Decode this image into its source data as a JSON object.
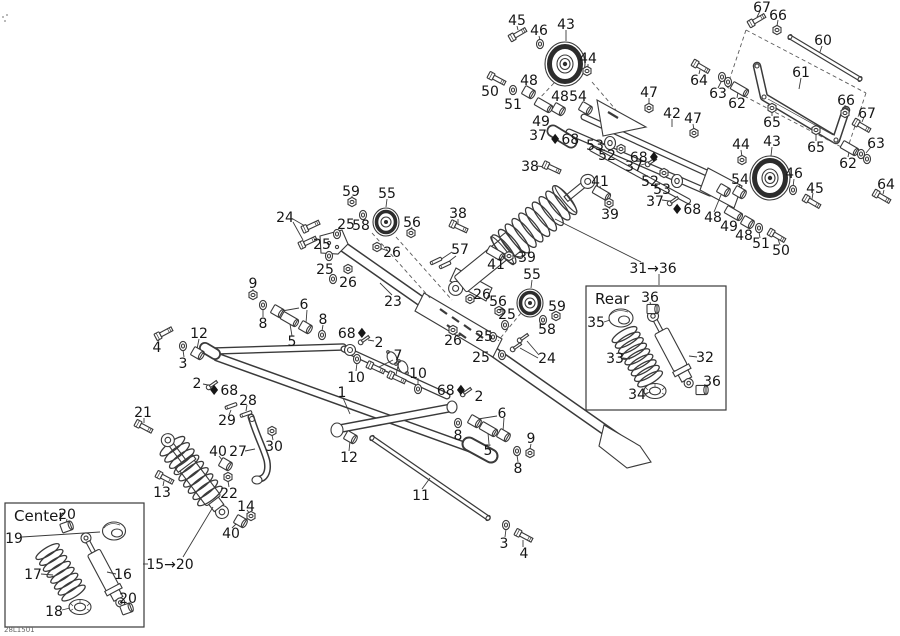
{
  "meta": {
    "drawing_number": "28L1501",
    "background": "#ffffff",
    "line_color": "#3a3a3a",
    "label_color": "#161616",
    "label_font_size": 14
  },
  "insets": [
    {
      "id": "center-inset",
      "label": "Center",
      "x": 5,
      "y": 503,
      "w": 139,
      "h": 124
    },
    {
      "id": "rear-inset",
      "label": "Rear",
      "x": 586,
      "y": 286,
      "w": 140,
      "h": 124
    }
  ],
  "callouts": [
    [
      "45",
      517,
      20
    ],
    [
      "46",
      539,
      30
    ],
    [
      "43",
      566,
      24
    ],
    [
      "44",
      588,
      58
    ],
    [
      "48",
      529,
      80
    ],
    [
      "50",
      490,
      91
    ],
    [
      "51",
      513,
      104
    ],
    [
      "49",
      541,
      121
    ],
    [
      "48",
      560,
      96
    ],
    [
      "54",
      578,
      96
    ],
    [
      "37",
      538,
      135
    ],
    [
      "♦68",
      564,
      139
    ],
    [
      "53",
      595,
      145
    ],
    [
      "52",
      607,
      155
    ],
    [
      "38",
      530,
      166
    ],
    [
      "38",
      458,
      213
    ],
    [
      "41",
      600,
      181
    ],
    [
      "39",
      610,
      214
    ],
    [
      "57",
      460,
      249
    ],
    [
      "41",
      496,
      264
    ],
    [
      "39",
      527,
      257
    ],
    [
      "55",
      532,
      274
    ],
    [
      "26",
      482,
      294
    ],
    [
      "56",
      498,
      301
    ],
    [
      "25",
      507,
      314
    ],
    [
      "59",
      557,
      306
    ],
    [
      "58",
      547,
      329
    ],
    [
      "26",
      453,
      340
    ],
    [
      "25",
      484,
      336
    ],
    [
      "25",
      481,
      357
    ],
    [
      "24",
      547,
      358
    ],
    [
      "59",
      351,
      191
    ],
    [
      "55",
      387,
      193
    ],
    [
      "24",
      285,
      217
    ],
    [
      "25",
      346,
      224
    ],
    [
      "58",
      361,
      225
    ],
    [
      "56",
      412,
      222
    ],
    [
      "25",
      322,
      244
    ],
    [
      "25",
      325,
      269
    ],
    [
      "26",
      348,
      282
    ],
    [
      "26",
      392,
      252
    ],
    [
      "23",
      393,
      301
    ],
    [
      "31→36",
      653,
      268
    ],
    [
      "9",
      253,
      283
    ],
    [
      "6",
      304,
      304
    ],
    [
      "8",
      263,
      323
    ],
    [
      "5",
      292,
      341
    ],
    [
      "8",
      323,
      319
    ],
    [
      "68♦",
      353,
      333
    ],
    [
      "2",
      379,
      342
    ],
    [
      "4",
      157,
      347
    ],
    [
      "12",
      199,
      333
    ],
    [
      "3",
      183,
      363
    ],
    [
      "2",
      197,
      383
    ],
    [
      "♦68",
      223,
      390
    ],
    [
      "10",
      356,
      377
    ],
    [
      "7",
      398,
      355
    ],
    [
      "10",
      418,
      373
    ],
    [
      "1",
      342,
      392
    ],
    [
      "68♦",
      452,
      390
    ],
    [
      "2",
      479,
      396
    ],
    [
      "8",
      458,
      435
    ],
    [
      "6",
      502,
      413
    ],
    [
      "5",
      488,
      450
    ],
    [
      "8",
      518,
      468
    ],
    [
      "9",
      531,
      438
    ],
    [
      "12",
      349,
      457
    ],
    [
      "11",
      421,
      495
    ],
    [
      "3",
      504,
      543
    ],
    [
      "4",
      524,
      553
    ],
    [
      "28",
      248,
      400
    ],
    [
      "29",
      227,
      420
    ],
    [
      "30",
      274,
      446
    ],
    [
      "27",
      238,
      451
    ],
    [
      "40",
      218,
      451
    ],
    [
      "21",
      143,
      412
    ],
    [
      "13",
      162,
      492
    ],
    [
      "22",
      229,
      493
    ],
    [
      "14",
      246,
      506
    ],
    [
      "40",
      231,
      533
    ],
    [
      "15→20",
      170,
      564
    ],
    [
      "42",
      672,
      113
    ],
    [
      "47",
      649,
      92
    ],
    [
      "47",
      693,
      118
    ],
    [
      "68♦",
      645,
      157
    ],
    [
      "37",
      634,
      166
    ],
    [
      "52",
      650,
      181
    ],
    [
      "53",
      662,
      189
    ],
    [
      "37",
      655,
      201
    ],
    [
      "♦68",
      686,
      209
    ],
    [
      "67",
      762,
      7
    ],
    [
      "66",
      778,
      15
    ],
    [
      "60",
      823,
      40
    ],
    [
      "61",
      801,
      72
    ],
    [
      "64",
      699,
      80
    ],
    [
      "63",
      718,
      93
    ],
    [
      "62",
      737,
      103
    ],
    [
      "65",
      772,
      122
    ],
    [
      "66",
      846,
      100
    ],
    [
      "67",
      867,
      113
    ],
    [
      "65",
      816,
      147
    ],
    [
      "63",
      876,
      143
    ],
    [
      "62",
      848,
      163
    ],
    [
      "64",
      886,
      184
    ],
    [
      "44",
      741,
      144
    ],
    [
      "43",
      772,
      141
    ],
    [
      "46",
      794,
      173
    ],
    [
      "45",
      815,
      188
    ],
    [
      "54",
      740,
      179
    ],
    [
      "48",
      713,
      217
    ],
    [
      "49",
      729,
      226
    ],
    [
      "48",
      744,
      235
    ],
    [
      "51",
      761,
      243
    ],
    [
      "50",
      781,
      250
    ],
    [
      "36",
      650,
      297
    ],
    [
      "35",
      596,
      322
    ],
    [
      "33",
      615,
      358
    ],
    [
      "32",
      705,
      357
    ],
    [
      "36",
      712,
      381
    ],
    [
      "34",
      637,
      394
    ],
    [
      "20",
      67,
      514
    ],
    [
      "19",
      14,
      538
    ],
    [
      "17",
      33,
      574
    ],
    [
      "16",
      123,
      574
    ],
    [
      "18",
      54,
      611
    ],
    [
      "20",
      128,
      598
    ]
  ],
  "leaders": [
    [
      293,
      219,
      305,
      226
    ],
    [
      293,
      222,
      303,
      240
    ],
    [
      299,
      308,
      282,
      311
    ],
    [
      307,
      310,
      306,
      323
    ],
    [
      292,
      336,
      290,
      324
    ],
    [
      263,
      317,
      263,
      309
    ],
    [
      253,
      289,
      253,
      292
    ],
    [
      323,
      325,
      322,
      331
    ],
    [
      184,
      357,
      183,
      350
    ],
    [
      199,
      339,
      197,
      349
    ],
    [
      158,
      341,
      162,
      337
    ],
    [
      203,
      384,
      208,
      385
    ],
    [
      374,
      341,
      368,
      340
    ],
    [
      393,
      360,
      379,
      367
    ],
    [
      399,
      361,
      396,
      375
    ],
    [
      356,
      371,
      357,
      363
    ],
    [
      418,
      378,
      418,
      385
    ],
    [
      343,
      398,
      350,
      414
    ],
    [
      422,
      489,
      430,
      478
    ],
    [
      349,
      451,
      350,
      441
    ],
    [
      505,
      537,
      506,
      529
    ],
    [
      523,
      547,
      523,
      540
    ],
    [
      531,
      444,
      530,
      449
    ],
    [
      518,
      462,
      517,
      455
    ],
    [
      497,
      416,
      478,
      419
    ],
    [
      504,
      418,
      503,
      431
    ],
    [
      489,
      444,
      488,
      433
    ],
    [
      392,
      295,
      380,
      283
    ],
    [
      387,
      199,
      386,
      207
    ],
    [
      532,
      280,
      531,
      288
    ],
    [
      412,
      227,
      411,
      230
    ],
    [
      388,
      251,
      380,
      248
    ],
    [
      539,
      355,
      527,
      341
    ],
    [
      538,
      358,
      520,
      348
    ],
    [
      452,
      252,
      440,
      260
    ],
    [
      456,
      256,
      447,
      263
    ],
    [
      537,
      166,
      546,
      167
    ],
    [
      458,
      219,
      458,
      224
    ],
    [
      600,
      186,
      601,
      190
    ],
    [
      496,
      259,
      495,
      256
    ],
    [
      610,
      209,
      609,
      206
    ],
    [
      521,
      257,
      514,
      256
    ],
    [
      672,
      119,
      672,
      127
    ],
    [
      649,
      98,
      649,
      105
    ],
    [
      693,
      124,
      694,
      130
    ],
    [
      641,
      165,
      648,
      163
    ],
    [
      662,
      200,
      669,
      201
    ],
    [
      601,
      145,
      607,
      144
    ],
    [
      144,
      418,
      144,
      423
    ],
    [
      163,
      486,
      164,
      481
    ],
    [
      219,
      456,
      223,
      461
    ],
    [
      229,
      487,
      228,
      481
    ],
    [
      245,
      451,
      255,
      449
    ],
    [
      273,
      440,
      272,
      435
    ],
    [
      247,
      405,
      246,
      411
    ],
    [
      229,
      415,
      231,
      410
    ],
    [
      247,
      510,
      250,
      514
    ],
    [
      232,
      528,
      237,
      523
    ],
    [
      148,
      564,
      143,
      564
    ],
    [
      183,
      557,
      213,
      507
    ],
    [
      641,
      262,
      555,
      219
    ],
    [
      659,
      274,
      659,
      285
    ],
    [
      116,
      574,
      107,
      572
    ],
    [
      41,
      574,
      53,
      575
    ],
    [
      22,
      537,
      100,
      532
    ],
    [
      62,
      610,
      70,
      608
    ],
    [
      67,
      519,
      66,
      524
    ],
    [
      128,
      603,
      127,
      606
    ],
    [
      604,
      322,
      610,
      320
    ],
    [
      623,
      358,
      630,
      359
    ],
    [
      697,
      357,
      689,
      356
    ],
    [
      650,
      302,
      651,
      306
    ],
    [
      709,
      385,
      704,
      388
    ],
    [
      644,
      394,
      650,
      392
    ],
    [
      588,
      64,
      588,
      68
    ],
    [
      517,
      26,
      518,
      30
    ],
    [
      539,
      36,
      540,
      40
    ],
    [
      822,
      46,
      820,
      52
    ],
    [
      801,
      78,
      799,
      89
    ],
    [
      699,
      74,
      700,
      70
    ],
    [
      718,
      88,
      722,
      80
    ],
    [
      737,
      98,
      738,
      92
    ],
    [
      772,
      116,
      772,
      112
    ],
    [
      778,
      20,
      777,
      26
    ],
    [
      760,
      11,
      757,
      17
    ],
    [
      845,
      105,
      845,
      110
    ],
    [
      864,
      117,
      862,
      122
    ],
    [
      816,
      141,
      816,
      134
    ],
    [
      871,
      147,
      866,
      153
    ],
    [
      884,
      190,
      883,
      194
    ],
    [
      848,
      157,
      849,
      152
    ],
    [
      741,
      150,
      742,
      157
    ],
    [
      794,
      179,
      793,
      187
    ],
    [
      813,
      193,
      812,
      199
    ],
    [
      740,
      184,
      739,
      189
    ],
    [
      714,
      212,
      721,
      195
    ],
    [
      780,
      245,
      778,
      239
    ],
    [
      760,
      238,
      759,
      232
    ],
    [
      566,
      30,
      566,
      41
    ],
    [
      772,
      147,
      771,
      156
    ],
    [
      352,
      196,
      352,
      199
    ],
    [
      453,
      335,
      453,
      332
    ]
  ],
  "dashed_lines": [
    [
      746,
      30,
      866,
      93
    ],
    [
      866,
      93,
      847,
      150
    ],
    [
      847,
      150,
      727,
      87
    ],
    [
      727,
      87,
      746,
      30
    ],
    [
      592,
      82,
      616,
      110
    ],
    [
      554,
      83,
      538,
      100
    ],
    [
      372,
      233,
      430,
      298
    ],
    [
      396,
      237,
      452,
      300
    ],
    [
      521,
      313,
      498,
      341
    ]
  ],
  "hardware": [
    [
      "bolt",
      518,
      34,
      -30
    ],
    [
      "washer",
      540,
      44,
      0
    ],
    [
      "nut",
      587,
      71,
      0
    ],
    [
      "bolt",
      497,
      79,
      28
    ],
    [
      "washer",
      513,
      90,
      0
    ],
    [
      "bushing",
      528,
      92,
      30
    ],
    [
      "spacer",
      543,
      105,
      30
    ],
    [
      "bushing",
      558,
      109,
      30
    ],
    [
      "bushing",
      585,
      108,
      30
    ],
    [
      "nut",
      649,
      108,
      0
    ],
    [
      "nut",
      694,
      133,
      0
    ],
    [
      "screw",
      651,
      162,
      -35
    ],
    [
      "nut",
      621,
      149,
      0
    ],
    [
      "disc",
      610,
      143,
      0
    ],
    [
      "nut",
      664,
      173,
      0
    ],
    [
      "disc",
      677,
      181,
      0
    ],
    [
      "screw",
      673,
      201,
      -35
    ],
    [
      "bolt",
      757,
      20,
      -30
    ],
    [
      "nut",
      777,
      30,
      0
    ],
    [
      "bolt",
      701,
      67,
      30
    ],
    [
      "washer",
      722,
      77,
      0
    ],
    [
      "washer",
      728,
      82,
      0
    ],
    [
      "spacer",
      739,
      89,
      30
    ],
    [
      "nut",
      772,
      108,
      0
    ],
    [
      "nut",
      845,
      113,
      0
    ],
    [
      "bolt",
      862,
      126,
      30
    ],
    [
      "nut",
      816,
      130,
      0
    ],
    [
      "spacer",
      849,
      148,
      30
    ],
    [
      "washer",
      861,
      154,
      0
    ],
    [
      "washer",
      867,
      159,
      0
    ],
    [
      "bolt",
      882,
      197,
      30
    ],
    [
      "nut",
      742,
      160,
      0
    ],
    [
      "washer",
      793,
      190,
      0
    ],
    [
      "bolt",
      812,
      202,
      30
    ],
    [
      "bushing",
      739,
      192,
      30
    ],
    [
      "bushing",
      723,
      190,
      30
    ],
    [
      "spacer",
      733,
      213,
      30
    ],
    [
      "bushing",
      747,
      222,
      30
    ],
    [
      "washer",
      759,
      228,
      0
    ],
    [
      "bolt",
      777,
      236,
      30
    ],
    [
      "nut",
      352,
      202,
      0
    ],
    [
      "washer",
      363,
      215,
      0
    ],
    [
      "nut",
      411,
      233,
      0
    ],
    [
      "nut",
      377,
      247,
      0
    ],
    [
      "nut",
      348,
      269,
      0
    ],
    [
      "bolt",
      311,
      226,
      -25
    ],
    [
      "bolt",
      308,
      242,
      -25
    ],
    [
      "washer",
      337,
      234,
      0
    ],
    [
      "washer",
      329,
      256,
      0
    ],
    [
      "washer",
      333,
      279,
      0
    ],
    [
      "nut",
      470,
      299,
      0
    ],
    [
      "nut",
      499,
      311,
      0
    ],
    [
      "washer",
      505,
      325,
      0
    ],
    [
      "washer",
      493,
      337,
      0
    ],
    [
      "washer",
      502,
      355,
      0
    ],
    [
      "screw",
      523,
      338,
      -35
    ],
    [
      "screw",
      516,
      347,
      -35
    ],
    [
      "nut",
      556,
      316,
      0
    ],
    [
      "washer",
      543,
      320,
      0
    ],
    [
      "nut",
      453,
      330,
      0
    ],
    [
      "bolt",
      552,
      168,
      25
    ],
    [
      "bolt",
      459,
      227,
      25
    ],
    [
      "spacer",
      601,
      193,
      30
    ],
    [
      "nut",
      609,
      203,
      0
    ],
    [
      "spacer",
      495,
      253,
      30
    ],
    [
      "nut",
      509,
      256,
      0
    ],
    [
      "pin",
      436,
      261,
      -25
    ],
    [
      "pin",
      445,
      265,
      -25
    ],
    [
      "nut",
      253,
      295,
      0
    ],
    [
      "washer",
      263,
      305,
      0
    ],
    [
      "bushing",
      277,
      311,
      30
    ],
    [
      "spacer",
      289,
      319,
      30
    ],
    [
      "bushing",
      305,
      327,
      30
    ],
    [
      "washer",
      322,
      335,
      0
    ],
    [
      "bolt",
      164,
      333,
      -28
    ],
    [
      "washer",
      183,
      346,
      0
    ],
    [
      "bushing",
      197,
      353,
      30
    ],
    [
      "screw",
      212,
      385,
      -35
    ],
    [
      "screw",
      364,
      340,
      -35
    ],
    [
      "screw",
      466,
      392,
      -35
    ],
    [
      "washer",
      357,
      359,
      0
    ],
    [
      "washer",
      418,
      389,
      0
    ],
    [
      "bolt",
      376,
      368,
      25
    ],
    [
      "bolt",
      397,
      378,
      25
    ],
    [
      "bushing",
      350,
      437,
      30
    ],
    [
      "washer",
      458,
      423,
      0
    ],
    [
      "bushing",
      474,
      421,
      30
    ],
    [
      "spacer",
      488,
      429,
      30
    ],
    [
      "bushing",
      503,
      435,
      30
    ],
    [
      "washer",
      517,
      451,
      0
    ],
    [
      "nut",
      530,
      453,
      0
    ],
    [
      "washer",
      506,
      525,
      0
    ],
    [
      "bolt",
      524,
      536,
      28
    ],
    [
      "pin",
      231,
      406,
      -20
    ],
    [
      "pin",
      246,
      414,
      -20
    ],
    [
      "nut",
      272,
      431,
      0
    ],
    [
      "bolt",
      144,
      427,
      28
    ],
    [
      "bolt",
      165,
      478,
      28
    ],
    [
      "bushing",
      225,
      464,
      30
    ],
    [
      "nut",
      228,
      477,
      0
    ],
    [
      "nut",
      251,
      516,
      0
    ],
    [
      "bushing",
      240,
      521,
      30
    ],
    [
      "bushing",
      652,
      309,
      0
    ],
    [
      "bushing",
      701,
      390,
      0
    ],
    [
      "bushing",
      66,
      527,
      -20
    ],
    [
      "bushing",
      126,
      609,
      -20
    ]
  ]
}
